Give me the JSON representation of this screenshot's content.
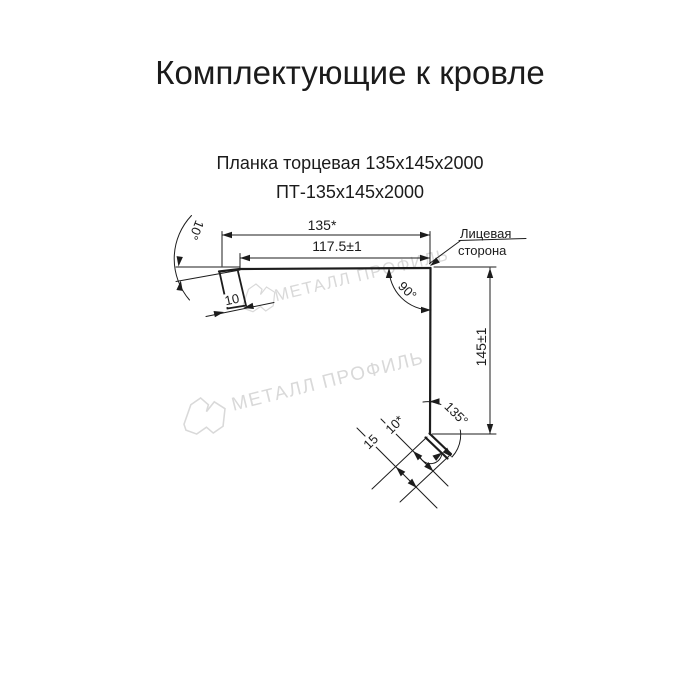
{
  "header": {
    "title": "Комплектующие к кровле",
    "product_name": "Планка торцевая 135х145х2000",
    "product_code": "ПТ-135х145х2000"
  },
  "drawing": {
    "dim_top_width": "135*",
    "dim_top_width_tol": "117.5±1",
    "dim_height": "145±1",
    "angle_corner": "90°",
    "angle_bottom": "135°",
    "angle_left": "10°",
    "dim_left_hem": "10",
    "dim_bottom_hem": "10*",
    "dim_bottom_hem_total": "15",
    "face_side_line1": "Лицевая",
    "face_side_line2": "сторона"
  },
  "watermark": {
    "text": "МЕТАЛЛ ПРОФИЛЬ",
    "color": "#d9d9d9"
  },
  "colors": {
    "line": "#1c1c1c",
    "background": "#ffffff"
  }
}
